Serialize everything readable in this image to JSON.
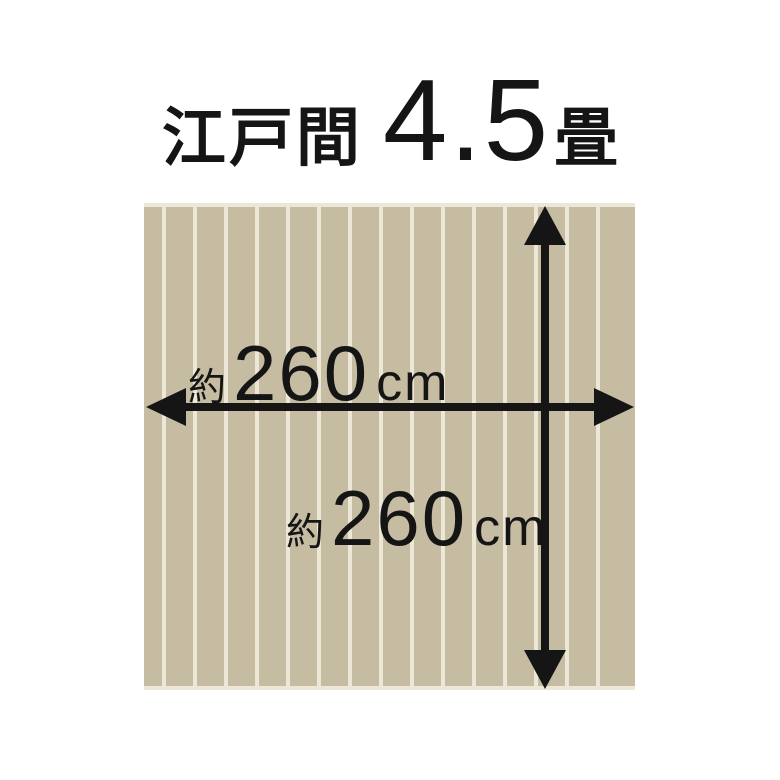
{
  "title": {
    "region": "江戸間",
    "size": "4.5",
    "size_unit": "畳"
  },
  "rug": {
    "width_label": {
      "approx": "約",
      "value": "260",
      "unit": "cm"
    },
    "height_label": {
      "approx": "約",
      "value": "260",
      "unit": "cm"
    }
  },
  "colors": {
    "background": "#ffffff",
    "plank": "#c6bca2",
    "plank_groove": "#ece7d6",
    "ink": "#151515"
  }
}
